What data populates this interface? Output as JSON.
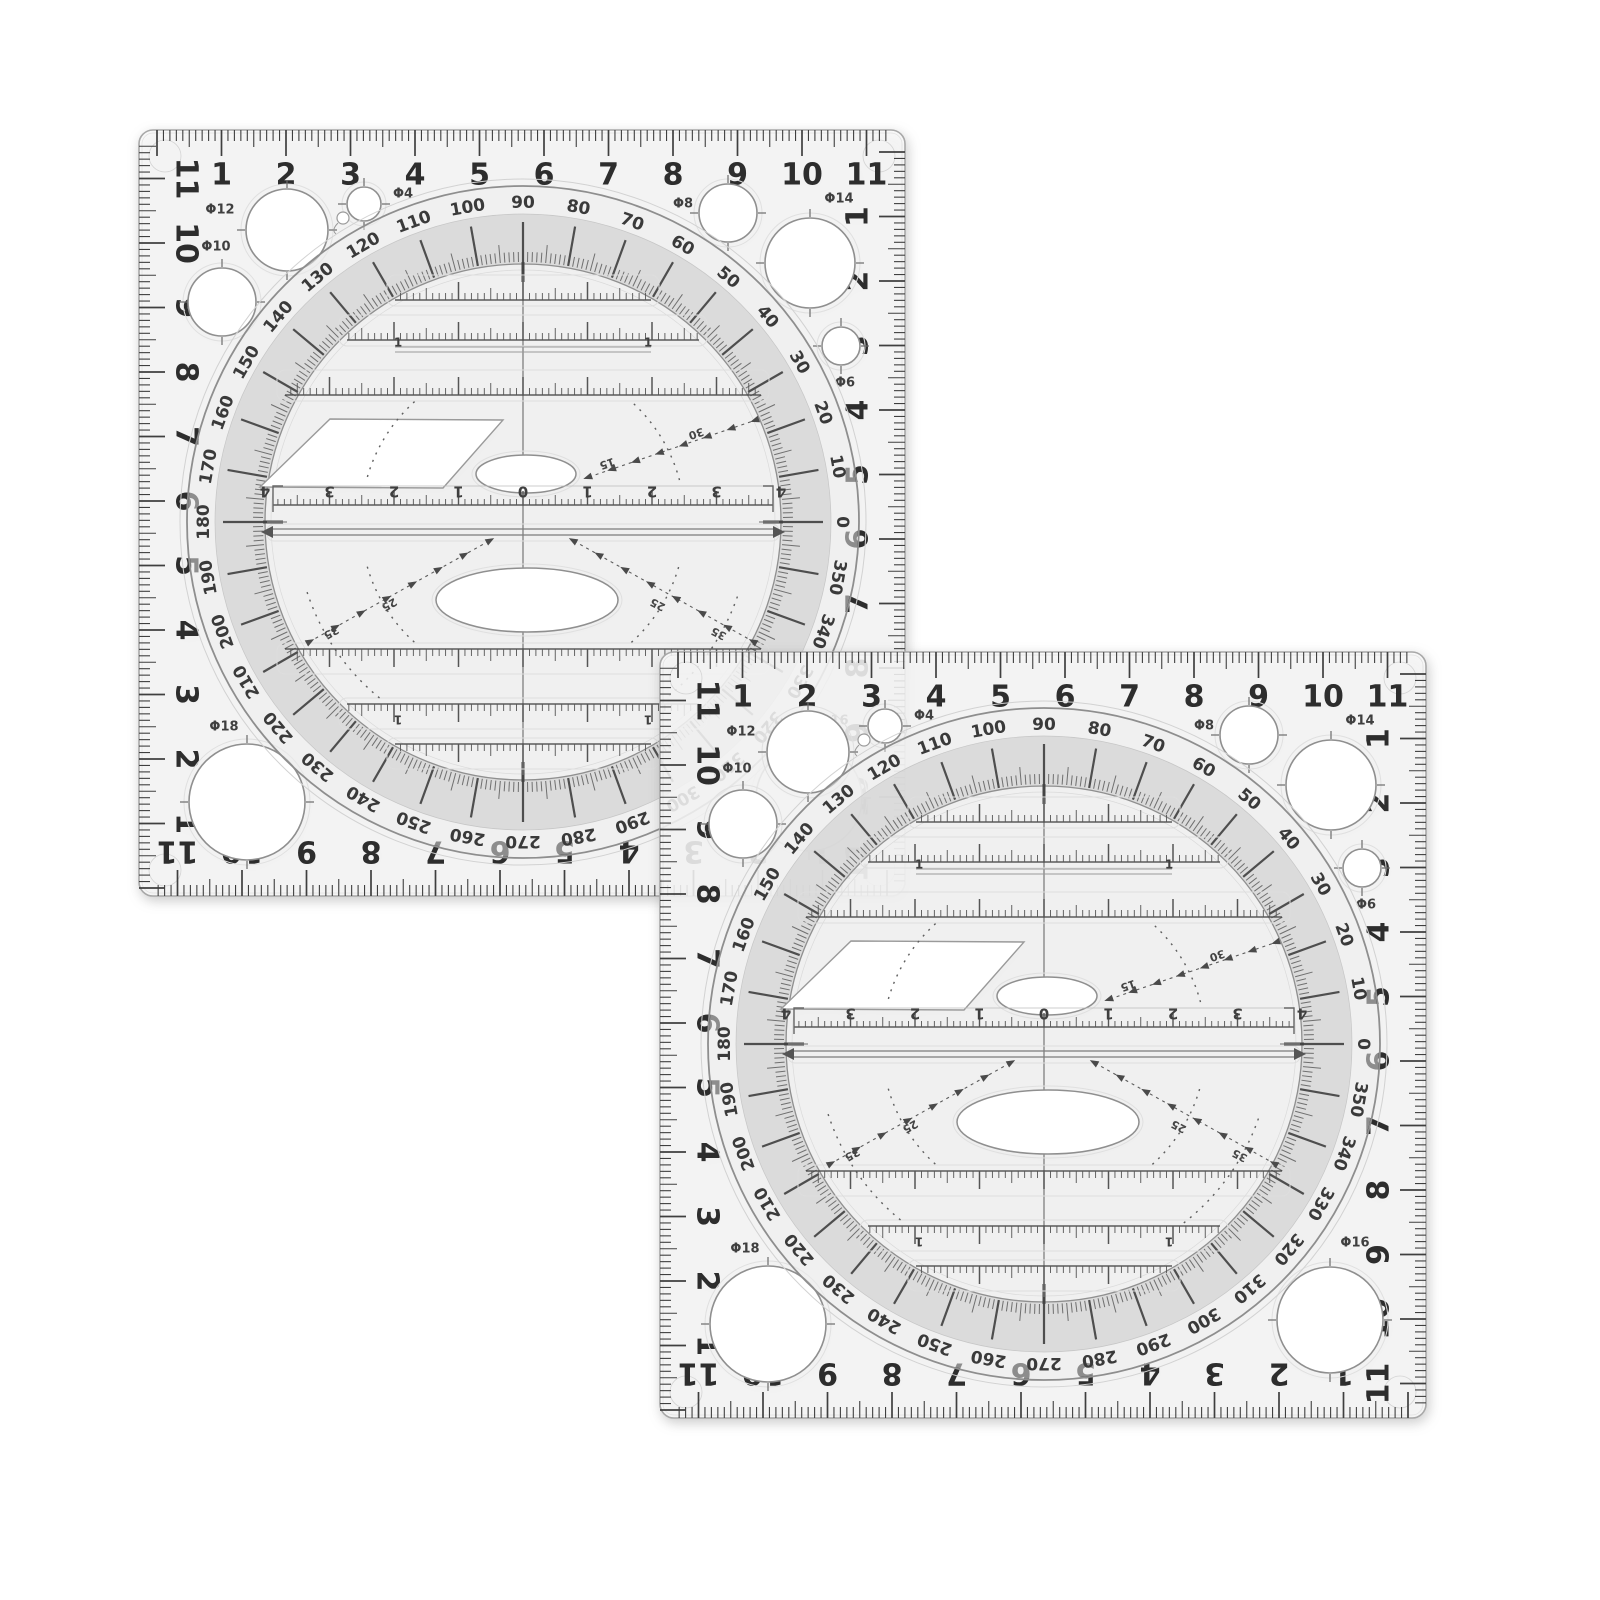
{
  "background_color": "#ffffff",
  "template": {
    "edge_numbers": [
      "1",
      "2",
      "3",
      "4",
      "5",
      "6",
      "7",
      "8",
      "9",
      "10",
      "11"
    ],
    "degree_labels": [
      "0",
      "10",
      "20",
      "30",
      "40",
      "50",
      "60",
      "70",
      "80",
      "90",
      "100",
      "110",
      "120",
      "130",
      "140",
      "150",
      "160",
      "170",
      "180",
      "190",
      "200",
      "210",
      "220",
      "230",
      "240",
      "250",
      "260",
      "270",
      "280",
      "290",
      "300",
      "310",
      "320",
      "330",
      "340",
      "350"
    ],
    "circle_cutouts": [
      {
        "name": "circle-cutout-phi-12",
        "label": "Φ12"
      },
      {
        "name": "circle-cutout-phi-4",
        "label": "Φ4"
      },
      {
        "name": "circle-cutout-phi-10",
        "label": "Φ10"
      },
      {
        "name": "circle-cutout-phi-8",
        "label": "Φ8"
      },
      {
        "name": "circle-cutout-phi-14",
        "label": "Φ14"
      },
      {
        "name": "circle-cutout-phi-6",
        "label": "Φ6"
      },
      {
        "name": "circle-cutout-phi-18",
        "label": "Φ18"
      },
      {
        "name": "circle-cutout-phi-16",
        "label": "Φ16"
      }
    ],
    "center_scale_numbers": [
      "4",
      "3",
      "2",
      "1",
      "0",
      "1",
      "2",
      "3",
      "4"
    ],
    "angle_guide_labels": {
      "upper": [
        "15",
        "30"
      ],
      "lower": [
        "25",
        "35"
      ]
    },
    "unit_mark": "1",
    "colors": {
      "ink": "#3f3f3f",
      "number": "#2d2d2d",
      "mid_gray": "#6f6f6f",
      "light_gray": "#c9c9c9",
      "plate_fill": "rgba(250,250,250,0.84)",
      "band_fill": "rgba(203,203,203,0.55)",
      "disc_tint": "rgba(238,238,238,0.5)",
      "cutout_fill": "#ffffff"
    }
  },
  "instances": [
    {
      "name": "drawing-template-back",
      "x": 135,
      "y": 126
    },
    {
      "name": "drawing-template-front",
      "x": 656,
      "y": 648
    }
  ]
}
